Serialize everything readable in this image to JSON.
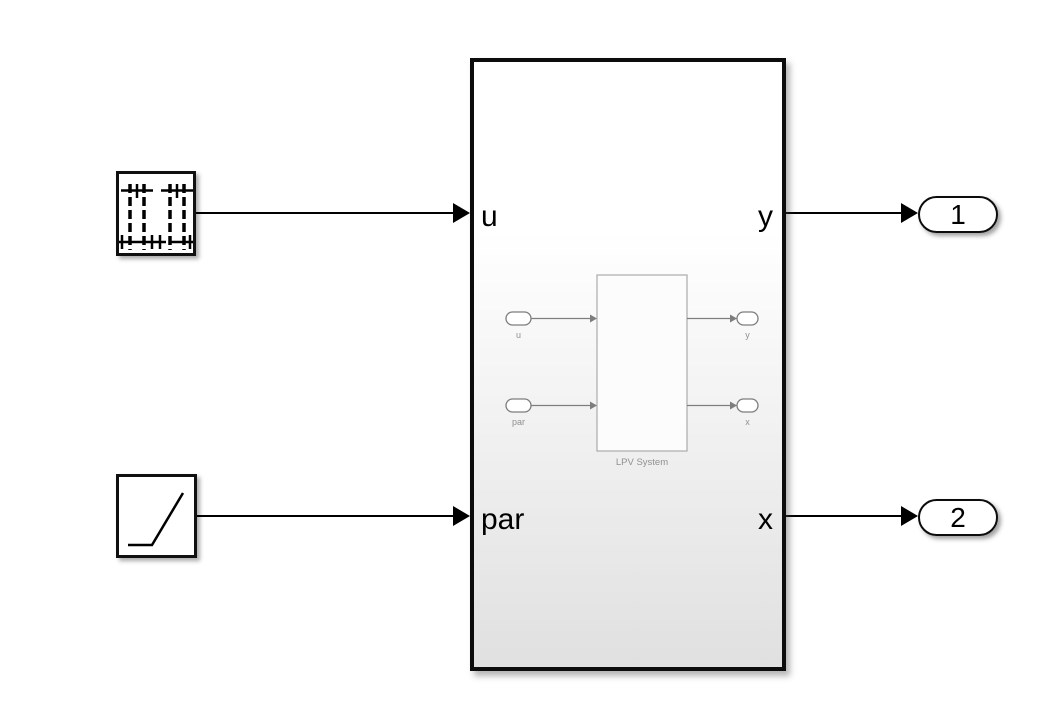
{
  "diagram": {
    "subsystem": {
      "port_in_1": "u",
      "port_in_2": "par",
      "port_out_1": "y",
      "port_out_2": "x",
      "preview": {
        "inport_1": "u",
        "inport_2": "par",
        "outport_1": "y",
        "outport_2": "x",
        "block_label": "LPV System"
      }
    },
    "outports": {
      "one": "1",
      "two": "2"
    },
    "icons": {
      "source_u": "stem-signal-icon",
      "source_par": "ramp-icon"
    },
    "colors": {
      "background": "#ffffff",
      "wire": "#000000",
      "block_border": "#0c0c0c",
      "gradient_bottom": "#e0e0e0",
      "preview_stroke": "#7d7d7d",
      "preview_rect_stroke": "#ababab",
      "preview_text": "#909090"
    }
  }
}
